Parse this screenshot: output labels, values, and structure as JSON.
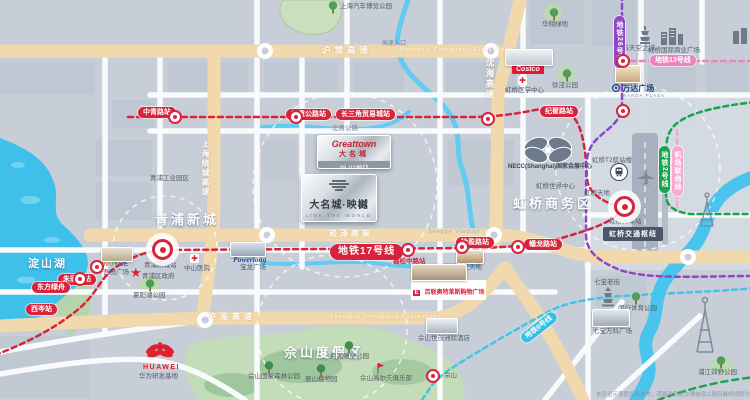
{
  "project": {
    "brand_en": "Greattown",
    "brand_cn": "大名城",
    "plot": "38-01地块",
    "name": "大名城·映樾",
    "tagline": "LINK THE WORLD"
  },
  "areas": [
    {
      "name": "青浦新城"
    },
    {
      "name": "虹桥商务区"
    },
    {
      "name": "佘山度假区"
    },
    {
      "name": "淀山湖"
    }
  ],
  "roads": [
    "沪常高速",
    "Shanghai Changzhou Expressway",
    "沈海高速",
    "上海绕城高速",
    "崧泽高架",
    "Songze Viaduct",
    "沪渝高速",
    "Shanghai Chongqing Expressway",
    "北青公路",
    "高速入口"
  ],
  "pills": [
    "中青路站",
    "赵重公路站",
    "长三角贸易城站",
    "纪翟路站",
    "地铁17号线",
    "朱家角站",
    "东方绿舟",
    "西岑站",
    "徐盈路站",
    "蟠龙路站",
    "地铁13号线",
    "地铁9号线",
    "地铁2号线",
    "机场联络线",
    "地铁26号线",
    "嘉松中路站"
  ],
  "pois": [
    "上海汽车博览公园",
    "华翔绿地",
    "徐泾公园",
    "万科天空之城",
    "虹桥国际商业广场",
    "虹桥医学中心",
    "虹桥世界中心",
    "虹桥天地",
    "虹桥T2航站楼",
    "虹桥火车站",
    "青浦新城站",
    "中山医院",
    "青浦区政府",
    "吾悦广场",
    "宝龙广场",
    "蟠龙天地",
    "夏阳湖公园",
    "佘山世茂洲际酒店",
    "月湖雕塑公园",
    "佘山国家森林公园",
    "辰山植物园",
    "佘山高尔夫俱乐部",
    "七宝老街",
    "七宝万科广场",
    "闵行体育公园",
    "浦江郊野公园",
    "佘山",
    "青浦工业园区"
  ],
  "logos": {
    "costco": "Costco",
    "wanda_cn": "万达广场",
    "wanda_en": "WANDA PLAZA",
    "necc": "NECC(Shanghai)国家会展中心",
    "hub": "虹桥交通枢纽",
    "wuyue": "WUYUE",
    "powerlong": "Powerlong",
    "outlets": "百联奥特莱斯购物广场",
    "huawei": "HUAWEI",
    "huawei_label": "华为研发基地"
  },
  "disclaimer": "本区位示意图仅供参考，道路及轨道交通信息以政府最终规划为准",
  "colors": {
    "metro_red": "#d8233c",
    "metro_pink": "#ef83c2",
    "metro_purple": "#8f46c8",
    "metro_green": "#1ba24f",
    "metro_cyan": "#40c6e8",
    "highway": "#f2d9ad",
    "water": "#45c2ec",
    "park": "#c3dcb9"
  }
}
